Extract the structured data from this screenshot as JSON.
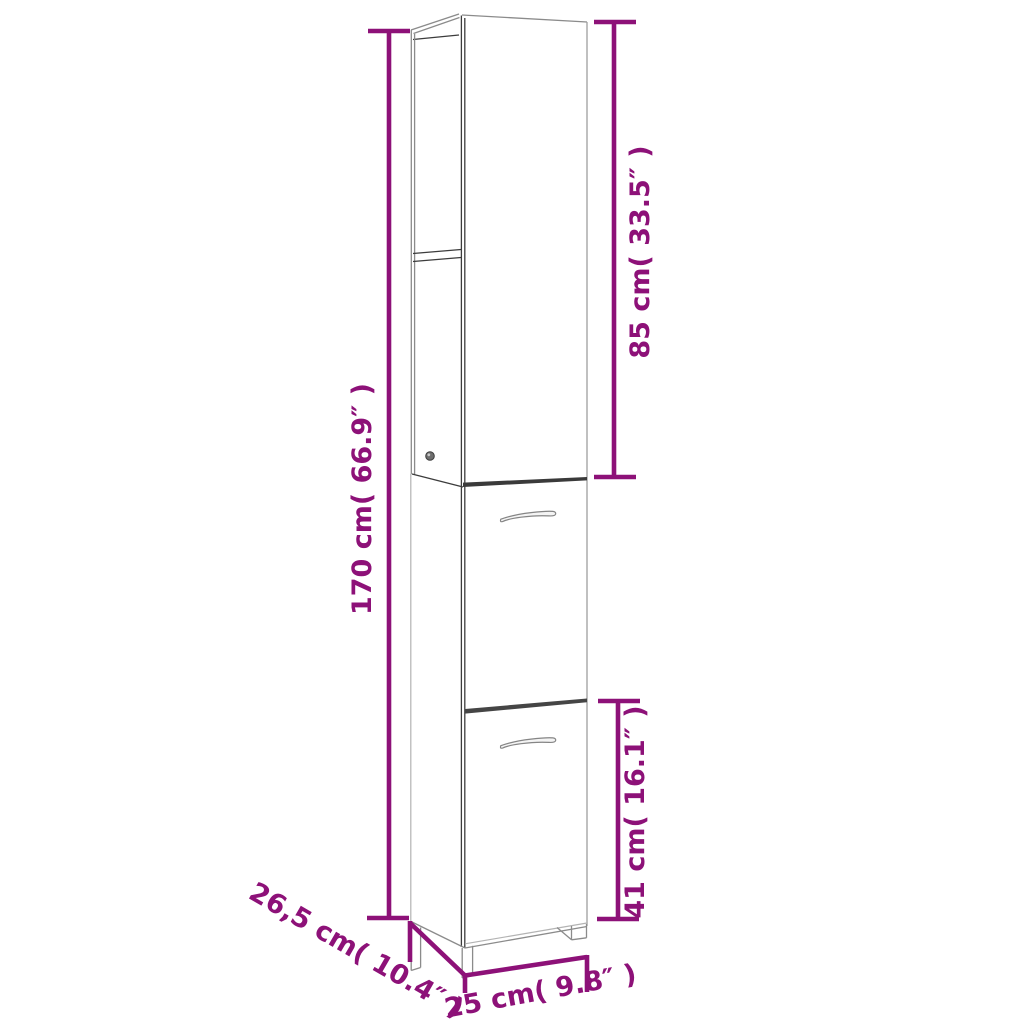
{
  "diagram": {
    "type": "furniture-dimension-diagram",
    "subject": "tall narrow bathroom cabinet with open top shelves and two doors",
    "accent_color": "#8d1178",
    "drawing_line_color": "#3c3c3c",
    "background_color": "#ffffff",
    "labels": {
      "height_total": "170 cm( 66.9″ )",
      "upper_section_height": "85 cm( 33.5″ )",
      "lower_section_height": "41 cm( 16.1″ )",
      "depth": "26,5 cm( 10.4″ )",
      "width": "25 cm( 9.8″ )"
    },
    "measurements": [
      {
        "name": "total height",
        "cm": 170,
        "inches": 66.9
      },
      {
        "name": "upper section height",
        "cm": 85,
        "inches": 33.5
      },
      {
        "name": "lower door section height",
        "cm": 41,
        "inches": 16.1
      },
      {
        "name": "depth",
        "cm": 26.5,
        "inches": 10.4
      },
      {
        "name": "width",
        "cm": 25,
        "inches": 9.8
      }
    ]
  }
}
